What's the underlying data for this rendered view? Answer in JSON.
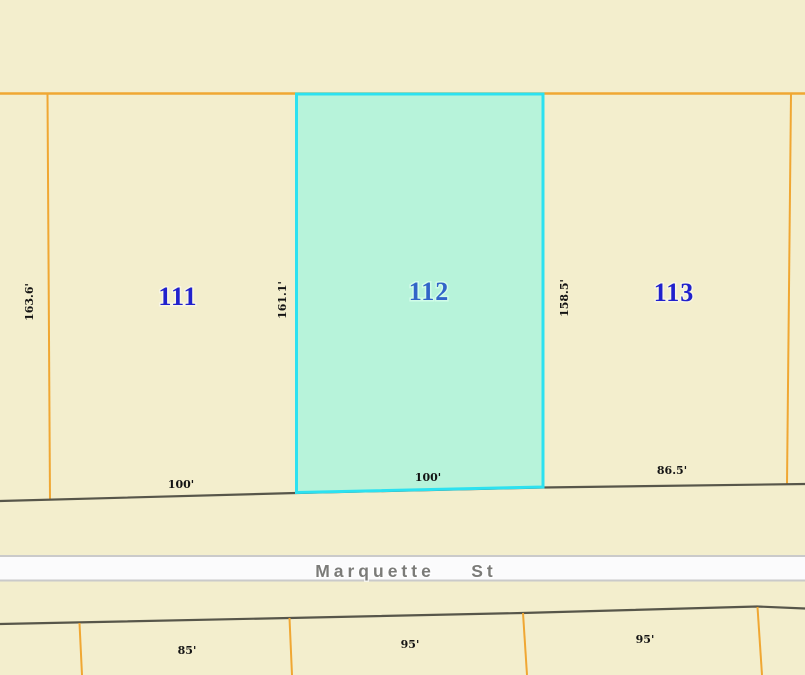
{
  "colors": {
    "background": "#f3eecd",
    "lot_boundary_line": "#f0a733",
    "street_edge_line": "#57564a",
    "street_band_fill": "#fbfbfc",
    "street_band_border": "#cacaca",
    "selected_parcel_fill": "#b7f3da",
    "selected_parcel_outline": "#2ce1f0",
    "lot_number_text": "#2121cd",
    "selected_lot_number_text": "#3264c8",
    "dimension_text": "#141414",
    "street_name_text": "#7b7b78"
  },
  "lots": {
    "lot111": {
      "number": "111",
      "side_dim": "163.6'",
      "front_dim": "100'"
    },
    "lot112": {
      "number": "112",
      "side_dim": "161.1'",
      "front_dim": "100'"
    },
    "lot113": {
      "number": "113",
      "side_dim": "158.5'",
      "front_dim": "86.5'"
    },
    "lot_south1": {
      "front_dim": "85'"
    },
    "lot_south2": {
      "front_dim": "95'"
    },
    "lot_south3": {
      "front_dim": "95'"
    }
  },
  "street": {
    "name": "Marquette St",
    "name_word1": "Marquette",
    "name_word2": "St"
  }
}
